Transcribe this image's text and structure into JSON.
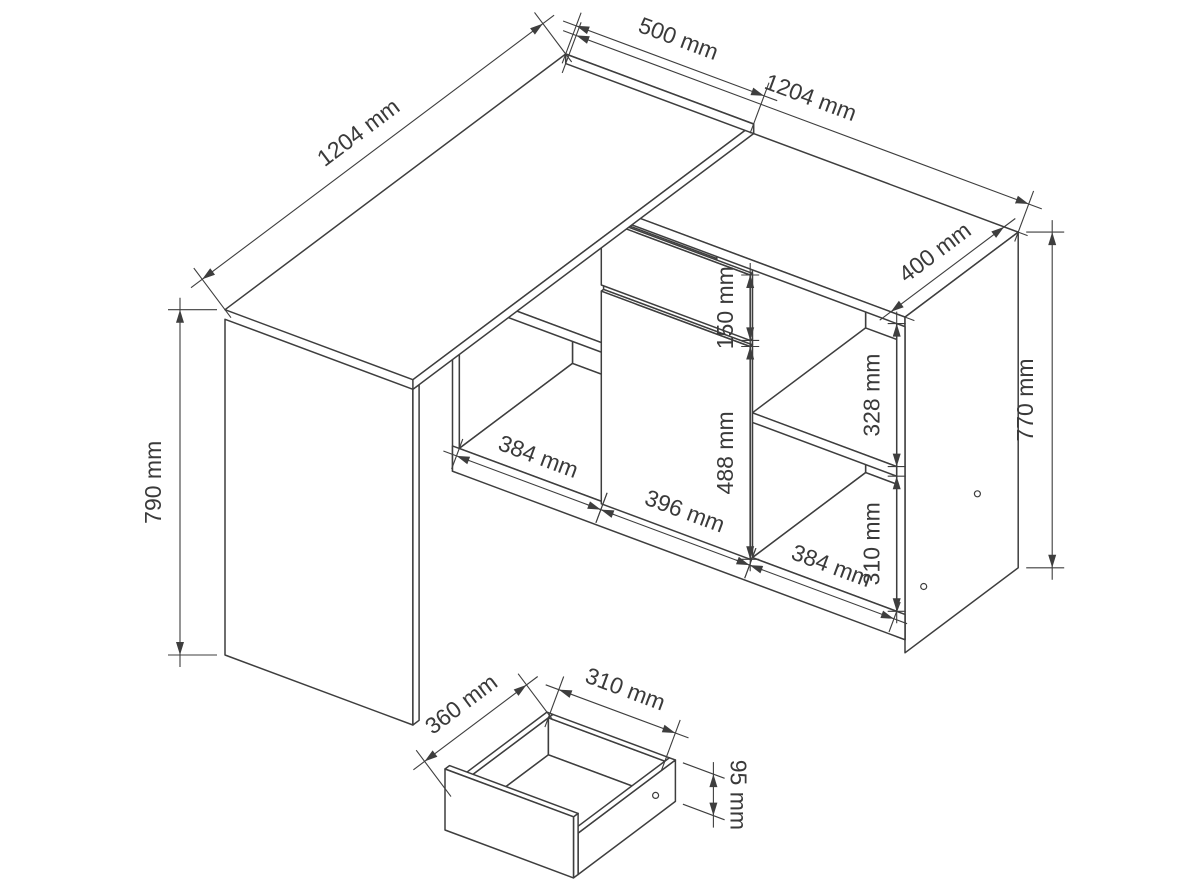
{
  "diagram": {
    "type": "furniture-technical-drawing",
    "subject": "corner desk with side cabinet and pull-out drawer",
    "unit": "mm",
    "background": "#ffffff",
    "line_color": "#3e3e3e",
    "text_color": "#3a3a3a",
    "labels": {
      "desk_length": "1204 mm",
      "desk_depth": "500 mm",
      "desk_height": "790 mm",
      "cabinet_length": "1204 mm",
      "cabinet_depth": "400 mm",
      "cabinet_height": "770 mm",
      "top_drawer_front_height": "150 mm",
      "door_height": "488 mm",
      "left_opening_width": "384 mm",
      "door_width": "396 mm",
      "right_opening_width": "384 mm",
      "upper_shelf_space": "328 mm",
      "lower_shelf_space": "310 mm",
      "drawer_depth": "360 mm",
      "drawer_width": "310 mm",
      "drawer_height": "95 mm"
    }
  }
}
